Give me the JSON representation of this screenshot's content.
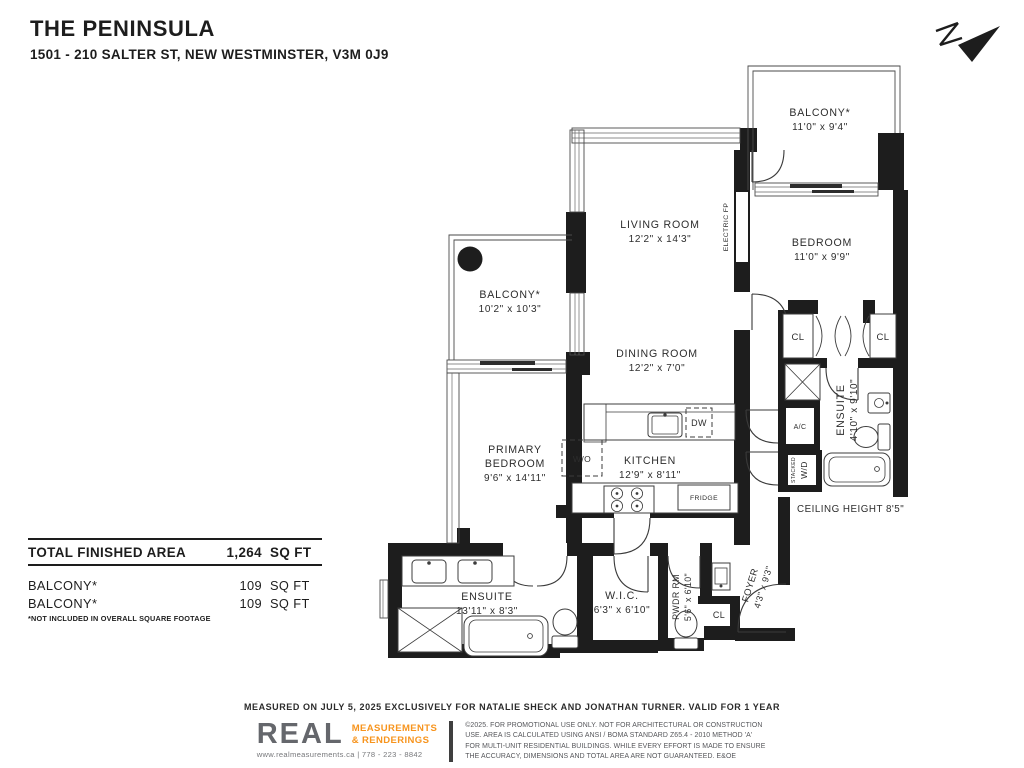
{
  "header": {
    "title": "THE PENINSULA",
    "address": "1501 - 210 SALTER ST, NEW WESTMINSTER, V3M 0J9"
  },
  "rooms": {
    "balcony_top": {
      "name": "BALCONY*",
      "dims": "11'0\" x 9'4\""
    },
    "bedroom": {
      "name": "BEDROOM",
      "dims": "11'0\" x 9'9\""
    },
    "living": {
      "name": "LIVING ROOM",
      "dims": "12'2\" x 14'3\""
    },
    "balcony_left": {
      "name": "BALCONY*",
      "dims": "10'2\" x 10'3\""
    },
    "dining": {
      "name": "DINING ROOM",
      "dims": "12'2\" x 7'0\""
    },
    "kitchen": {
      "name": "KITCHEN",
      "dims": "12'9\" x 8'11\""
    },
    "primary": {
      "name": "PRIMARY",
      "name2": "BEDROOM",
      "dims": "9'6\" x 14'11\""
    },
    "ensuite_upper": {
      "name": "ENSUITE",
      "dims": "4'10\" x 9'10\""
    },
    "ensuite_lower": {
      "name": "ENSUITE",
      "dims": "13'11\" x 8'3\""
    },
    "wic": {
      "name": "W.I.C.",
      "dims": "6'3\" x 6'10\""
    },
    "pwdr": {
      "name": "PWDR RM",
      "dims": "5'6\" x 6'10\""
    },
    "foyer": {
      "name": "FOYER",
      "dims": "4'3\" x 9'3\""
    }
  },
  "fixtures": {
    "dw": "DW",
    "wo": "W/O",
    "fridge": "FRIDGE",
    "ac": "A/C",
    "stacked": "STACKED",
    "wd": "W/D",
    "cl1": "CL",
    "cl2": "CL",
    "cl3": "CL",
    "electric_fp": "ELECTRIC FP"
  },
  "notes": {
    "ceiling": "CEILING HEIGHT 8'5\""
  },
  "areas": {
    "total_label": "TOTAL FINISHED AREA",
    "total_value": "1,264",
    "total_unit": "SQ FT",
    "rows": [
      {
        "label": "BALCONY*",
        "value": "109",
        "unit": "SQ FT"
      },
      {
        "label": "BALCONY*",
        "value": "109",
        "unit": "SQ FT"
      }
    ],
    "footnote": "*NOT INCLUDED IN OVERALL SQUARE FOOTAGE"
  },
  "footer": {
    "measured": "MEASURED ON JULY 5, 2025 EXCLUSIVELY FOR NATALIE SHECK AND JONATHAN TURNER. VALID FOR 1 YEAR",
    "logo_text": "REAL",
    "logo_sub1": "MEASUREMENTS",
    "logo_sub2": "& RENDERINGS",
    "logo_contact": "www.realmeasurements.ca | 778 - 223 - 8842",
    "disclaimer": "©2025. FOR PROMOTIONAL USE ONLY. NOT FOR ARCHITECTURAL OR CONSTRUCTION USE. AREA IS CALCULATED USING ANSI / BOMA STANDARD Z65.4 - 2010 METHOD 'A' FOR MULTI-UNIT RESIDENTIAL BUILDINGS. WHILE EVERY EFFORT IS MADE TO ENSURE THE ACCURACY, DIMENSIONS AND TOTAL AREA ARE NOT GUARANTEED. E&OE"
  },
  "colors": {
    "wall": "#1d1d1d",
    "accent_orange": "#f7941d",
    "logo_gray": "#65676c"
  }
}
